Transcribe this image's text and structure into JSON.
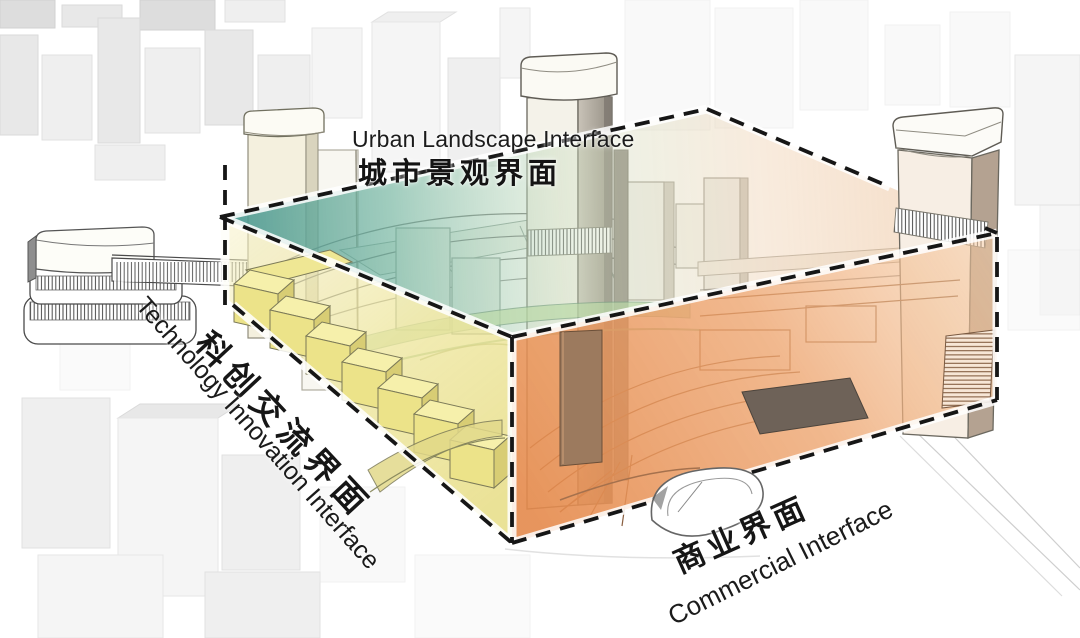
{
  "diagram": {
    "type": "axonometric-urban-design-interface-diagram",
    "labels": {
      "urban_landscape": {
        "en": "Urban Landscape Interface",
        "cn": "城市景观界面"
      },
      "technology_innovation": {
        "cn": "科创交流界面",
        "en": "Technology Innovation Interface"
      },
      "commercial": {
        "cn": "商业界面",
        "en": "Commercial Interface"
      }
    },
    "colors": {
      "landscape_plane_teal": "#44948E",
      "innovation_face_yellow": "#EDE59A",
      "commercial_face_orange": "#E58A4C",
      "dash_outline": "#161616"
    }
  }
}
